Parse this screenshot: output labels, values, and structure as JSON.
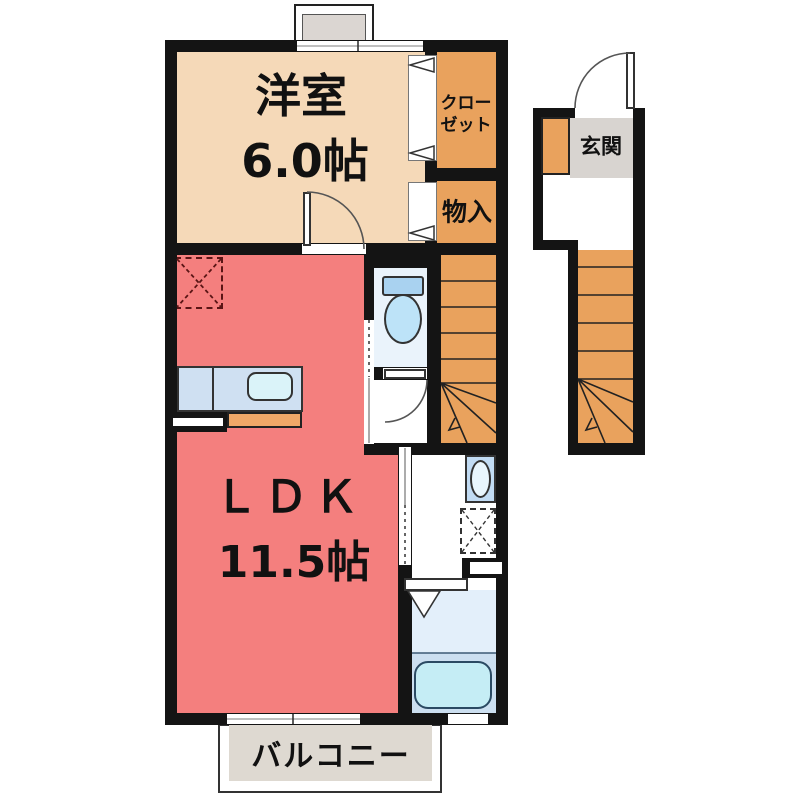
{
  "rooms": {
    "western_room": {
      "name_label": "洋室",
      "size_label": "6.0帖"
    },
    "ldk": {
      "name_label": "ＬＤＫ",
      "size_label": "11.5帖"
    },
    "closet": {
      "label_line1": "クロー",
      "label_line2": "ゼット"
    },
    "storage": {
      "label": "物入"
    },
    "entrance": {
      "label": "玄関"
    },
    "balcony": {
      "label": "バルコニー"
    }
  },
  "icons": {
    "toilet": "toilet-icon",
    "bathtub": "bathtub-icon",
    "kitchen_sink": "kitchen-sink-icon",
    "washbasin": "washbasin-icon",
    "washing_machine_space": "washing-machine-space-icon",
    "refrigerator_space": "refrigerator-space-icon",
    "shoe_cabinet": "shoe-cabinet-icon",
    "stairs": "stairs-icon",
    "door_swing": "door-swing-icon",
    "sliding_door": "sliding-door-icon",
    "folding_door": "folding-door-icon",
    "window": "window-icon"
  },
  "colors": {
    "wall": "#141414",
    "room_western": "#f5d9b8",
    "room_orange": "#e9a25d",
    "room_ldk": "#f47f7e",
    "toilet_floor": "#eaf3fb",
    "fixture_blue": "#a9d2f0",
    "fixture_blue_light": "#bde3f8",
    "kitchen_counter": "#cfe0f2",
    "kitchen_sink": "#daf3f9",
    "kitchen_cabinet": "#f0a868",
    "bath_upper": "#e3effa",
    "bath_lower": "#ccdff0",
    "bathtub": "#c5edf5",
    "basin_box": "#c2dcf4",
    "entrance_floor": "#d8d4d0",
    "balcony_floor": "#ded9d1",
    "window_box": "#dbd6d2",
    "text": "#111111"
  }
}
